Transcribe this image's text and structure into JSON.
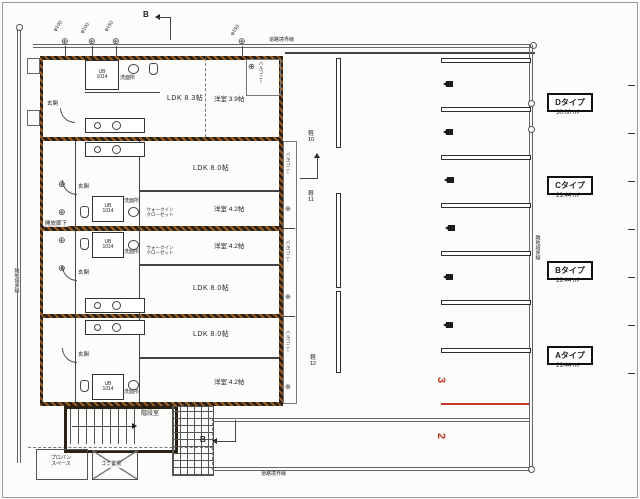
{
  "boundary": {
    "road_top": "道路境界線",
    "road_bottom": "道路境界線",
    "neighbor_left": "隣地境界線",
    "neighbor_right": "隣地境界線"
  },
  "section_label": "B",
  "pipes": {
    "p1": "φ100",
    "p2": "φ100",
    "p3": "φ150",
    "p4": "φ150"
  },
  "units": {
    "d": {
      "ldk": "LDK 8.3帖",
      "bedroom": "洋室 3.9帖",
      "entrance": "玄関",
      "bath1": "UB",
      "bath2": "1014",
      "wash": "洗面所",
      "balcony": "バルコニー"
    },
    "c": {
      "ldk": "LDK 8.0帖",
      "bedroom": "洋室 4.2帖",
      "entrance": "玄関",
      "bath1": "UB",
      "bath2": "1014",
      "wash": "洗面所",
      "closet1": "ウォークイン",
      "closet2": "クローゼット",
      "balcony": "バルコニー"
    },
    "b": {
      "ldk": "LDK 8.0帖",
      "bedroom": "洋室 4.2帖",
      "entrance": "玄関",
      "bath1": "UB",
      "bath2": "1014",
      "wash": "洗面所",
      "closet1": "ウォークイン",
      "closet2": "クローゼット",
      "balcony": "バルコニー"
    },
    "a": {
      "ldk": "LDK 8.0帖",
      "bedroom": "洋室 4.2帖",
      "entrance": "玄関",
      "bath1": "UB",
      "bath2": "1014",
      "wash": "洗面所",
      "balcony": "バルコニー"
    }
  },
  "common": {
    "corridor": "開放廊下",
    "stairs": "階段室",
    "propane1": "プロパン",
    "propane2": "スペース",
    "garbage": "ゴミ置場"
  },
  "types": [
    {
      "name": "Dタイプ",
      "area": "30.00 m²"
    },
    {
      "name": "Cタイプ",
      "area": "29.44 m²"
    },
    {
      "name": "Bタイプ",
      "area": "29.44 m²"
    },
    {
      "name": "Aタイプ",
      "area": "29.44 m²"
    }
  ],
  "parking": {
    "kei": [
      {
        "t": "軽",
        "n": "10"
      },
      {
        "t": "軽",
        "n": "11"
      },
      {
        "t": "軽",
        "n": "12"
      }
    ],
    "red": {
      "n3": "3",
      "n2": "2"
    }
  },
  "colors": {
    "wall_dark": "#2b2115",
    "wall_hatch": "#b26a28",
    "line": "#444444",
    "red": "#c43427"
  }
}
